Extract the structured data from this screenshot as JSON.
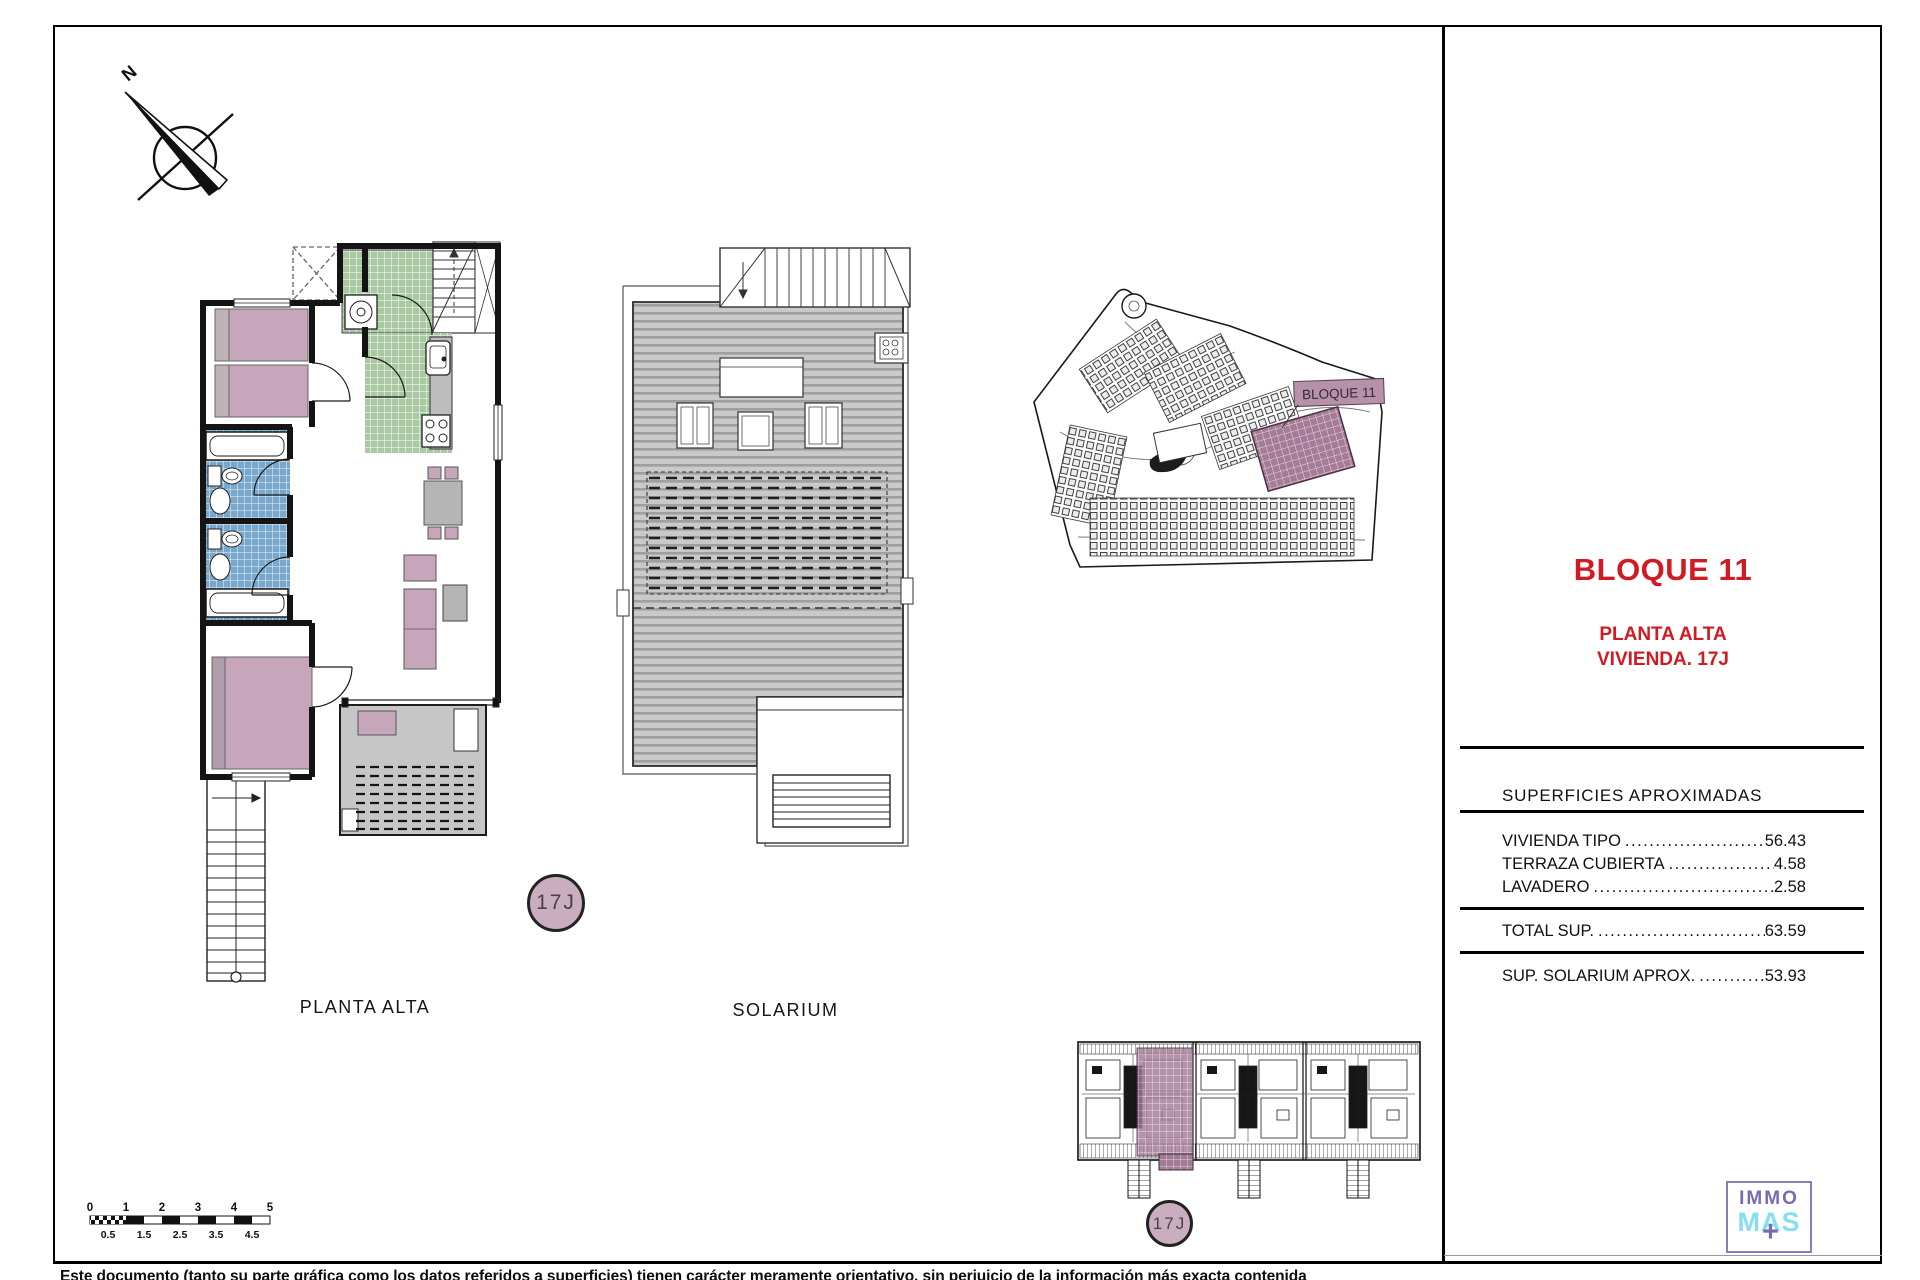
{
  "compass": {
    "n": "N"
  },
  "plans": {
    "planta_alta_label": "PLANTA ALTA",
    "solarium_label": "SOLARIUM",
    "unit_badge_plan": "17J",
    "unit_badge_elevation": "17J",
    "site_block_label": "BLOQUE 11"
  },
  "panel": {
    "title": "BLOQUE 11",
    "subtitle_line1": "PLANTA ALTA",
    "subtitle_line2": "VIVIENDA. 17J",
    "table_header": "SUPERFICIES APROXIMADAS",
    "rows": [
      {
        "label": "VIVIENDA TIPO",
        "dots": "............................................................",
        "value": "56.43"
      },
      {
        "label": "TERRAZA CUBIERTA",
        "dots": "............................................................",
        "value": "4.58"
      },
      {
        "label": "LAVADERO",
        "dots": "............................................................",
        "value": "2.58"
      }
    ],
    "total": {
      "label": "TOTAL SUP.",
      "dots": "............................................................",
      "value": "63.59"
    },
    "solarium": {
      "label": "SUP. SOLARIUM APROX.",
      "dots": "............................................................",
      "value": "53.93"
    }
  },
  "scalebar": {
    "top": [
      "0",
      "1",
      "2",
      "3",
      "4",
      "5"
    ],
    "bottom": [
      "0.5",
      "1.5",
      "2.5",
      "3.5",
      "4.5"
    ]
  },
  "logo": {
    "line1": "IMMO",
    "line2": "MAS",
    "plus": "+"
  },
  "footer": {
    "disclaimer": "Este documento (tanto su parte gráfica como los datos referidos a superficies) tienen carácter meramente orientativo, sin perjuicio de la información más exacta contenida"
  },
  "colors": {
    "accent_red": "#d11a21",
    "furniture_mauve": "#c7a6bb",
    "highlight_mauve": "#a57c98",
    "tile_blue": "#79a8cd",
    "tile_green": "#a8c9a1",
    "deck_gray": "#c9c9c9",
    "logo_purple": "#7a6ab0",
    "logo_cyan": "#85dff0"
  }
}
